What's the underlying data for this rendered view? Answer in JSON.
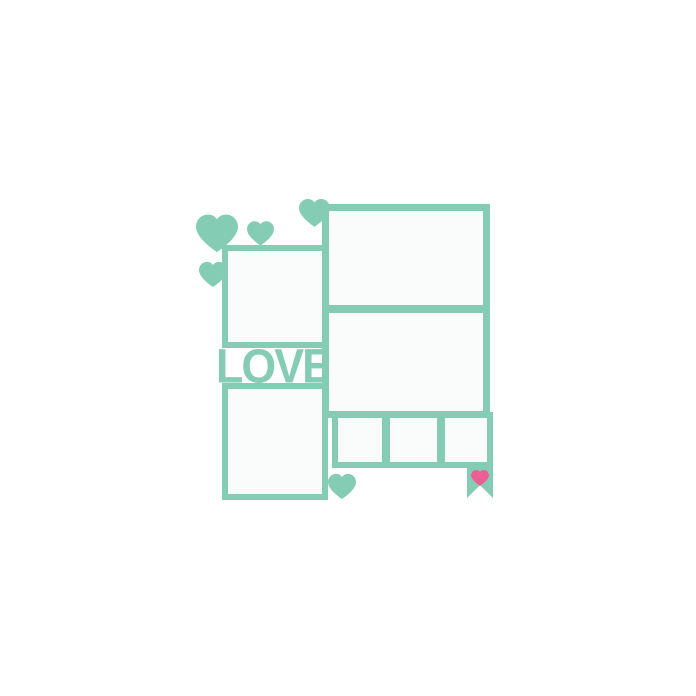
{
  "artwork": {
    "word": "LOVE",
    "colors": {
      "teal": "#84ccb4",
      "pink": "#ee5d94",
      "window_fill": "#f9fcfa",
      "background": "#ffffff"
    },
    "hearts": {
      "teal_count": 5,
      "pink_count": 1
    },
    "photo_windows": {
      "left_column": 2,
      "right_column": 2,
      "bottom_strip": 3
    }
  }
}
